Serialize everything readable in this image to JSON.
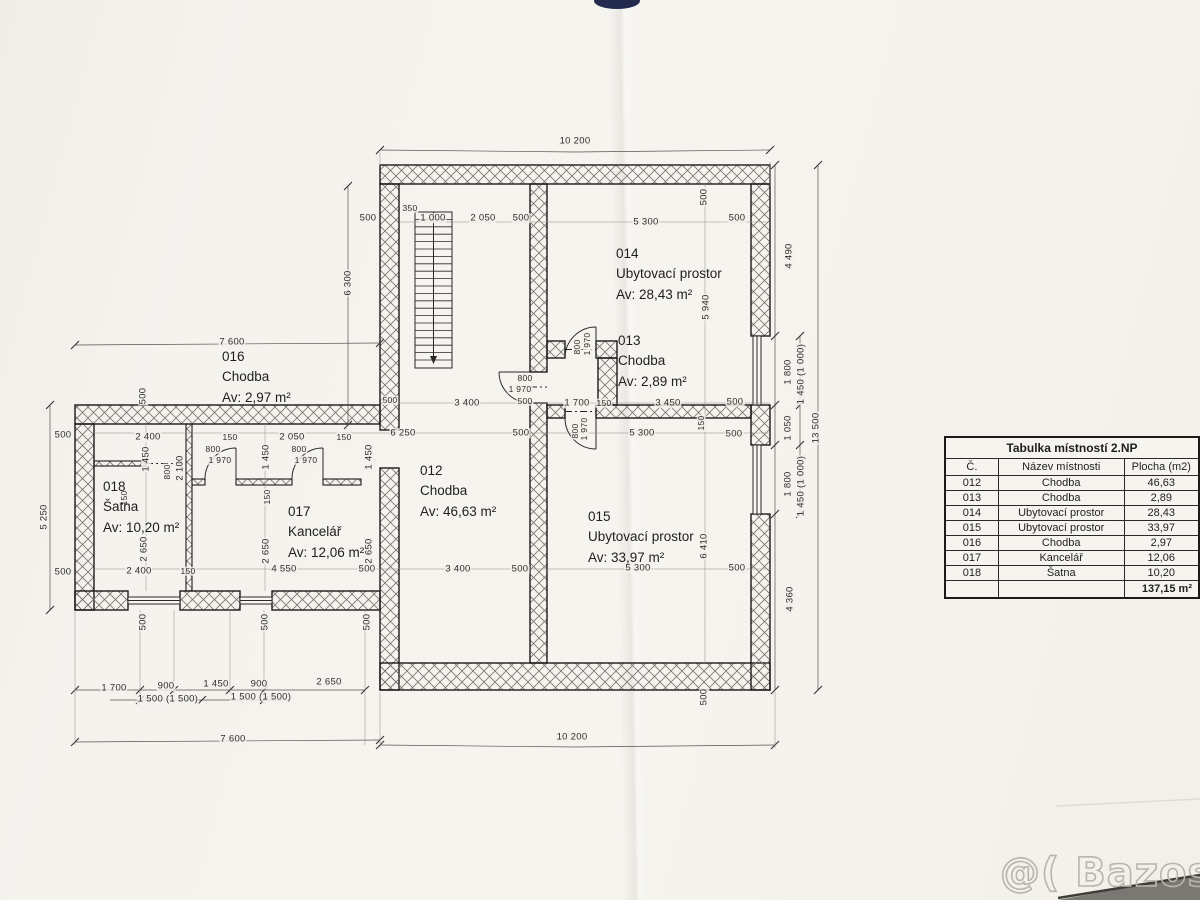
{
  "table": {
    "title": "Tabulka místností 2.NP",
    "headers": [
      "Č.",
      "Název místnosti",
      "Plocha (m2)"
    ],
    "rows": [
      [
        "012",
        "Chodba",
        "46,63"
      ],
      [
        "013",
        "Chodba",
        "2,89"
      ],
      [
        "014",
        "Ubytovací prostor",
        "28,43"
      ],
      [
        "015",
        "Ubytovací prostor",
        "33,97"
      ],
      [
        "016",
        "Chodba",
        "2,97"
      ],
      [
        "017",
        "Kancelář",
        "12,06"
      ],
      [
        "018",
        "Šatna",
        "10,20"
      ]
    ],
    "total": "137,15 m²"
  },
  "rooms": [
    {
      "num": "012",
      "name": "Chodba",
      "area": "Av: 46,63 m²",
      "x": 420,
      "y": 461
    },
    {
      "num": "013",
      "name": "Chodba",
      "area": "Av: 2,89 m²",
      "x": 618,
      "y": 331
    },
    {
      "num": "014",
      "name": "Ubytovací prostor",
      "area": "Av: 28,43 m²",
      "x": 616,
      "y": 244
    },
    {
      "num": "015",
      "name": "Ubytovací prostor",
      "area": "Av: 33,97 m²",
      "x": 588,
      "y": 507
    },
    {
      "num": "016",
      "name": "Chodba",
      "area": "Av: 2,97 m²",
      "x": 222,
      "y": 347
    },
    {
      "num": "017",
      "name": "Kancelář",
      "area": "Av: 12,06 m²",
      "x": 288,
      "y": 502
    },
    {
      "num": "018",
      "name": "Šatna",
      "area": "Av: 10,20 m²",
      "x": 103,
      "y": 477
    }
  ],
  "dimensions": [
    {
      "t": "10 200",
      "x": 575,
      "y": 141
    },
    {
      "t": "500",
      "x": 368,
      "y": 218
    },
    {
      "t": "350",
      "x": 410,
      "y": 208,
      "sm": true
    },
    {
      "t": "1 000",
      "x": 433,
      "y": 218
    },
    {
      "t": "2 050",
      "x": 483,
      "y": 218
    },
    {
      "t": "500",
      "x": 521,
      "y": 218
    },
    {
      "t": "5 300",
      "x": 646,
      "y": 222
    },
    {
      "t": "500",
      "x": 737,
      "y": 218
    },
    {
      "t": "500",
      "x": 704,
      "y": 197,
      "rot": true
    },
    {
      "t": "6 300",
      "x": 348,
      "y": 283,
      "rot": true
    },
    {
      "t": "5 940",
      "x": 706,
      "y": 307,
      "rot": true
    },
    {
      "t": "4 490",
      "x": 789,
      "y": 256,
      "rot": true
    },
    {
      "t": "7 600",
      "x": 232,
      "y": 342
    },
    {
      "t": "800",
      "x": 525,
      "y": 378,
      "sm": true
    },
    {
      "t": "1 970",
      "x": 520,
      "y": 389,
      "sm": true
    },
    {
      "t": "500",
      "x": 525,
      "y": 401,
      "sm": true
    },
    {
      "t": "3 400",
      "x": 467,
      "y": 403
    },
    {
      "t": "1 700",
      "x": 577,
      "y": 403
    },
    {
      "t": "150",
      "x": 604,
      "y": 403,
      "sm": true
    },
    {
      "t": "3 450",
      "x": 668,
      "y": 403
    },
    {
      "t": "500",
      "x": 735,
      "y": 402
    },
    {
      "t": "800",
      "x": 577,
      "y": 347,
      "rot": true,
      "sm": true
    },
    {
      "t": "1 970",
      "x": 587,
      "y": 344,
      "rot": true,
      "sm": true
    },
    {
      "t": "500",
      "x": 63,
      "y": 435
    },
    {
      "t": "500",
      "x": 63,
      "y": 572
    },
    {
      "t": "5 250",
      "x": 44,
      "y": 517,
      "rot": true
    },
    {
      "t": "500",
      "x": 143,
      "y": 396,
      "rot": true
    },
    {
      "t": "500",
      "x": 390,
      "y": 400,
      "sm": true
    },
    {
      "t": "2 400",
      "x": 148,
      "y": 437
    },
    {
      "t": "150",
      "x": 230,
      "y": 437,
      "sm": true
    },
    {
      "t": "2 050",
      "x": 292,
      "y": 437
    },
    {
      "t": "150",
      "x": 344,
      "y": 437,
      "sm": true
    },
    {
      "t": "1 450",
      "x": 146,
      "y": 459,
      "rot": true
    },
    {
      "t": "1 450",
      "x": 266,
      "y": 457,
      "rot": true
    },
    {
      "t": "1 450",
      "x": 369,
      "y": 457,
      "rot": true
    },
    {
      "t": "800",
      "x": 213,
      "y": 449,
      "sm": true
    },
    {
      "t": "1 970",
      "x": 220,
      "y": 460,
      "sm": true
    },
    {
      "t": "800",
      "x": 299,
      "y": 449,
      "sm": true
    },
    {
      "t": "1 970",
      "x": 306,
      "y": 460,
      "sm": true
    },
    {
      "t": "800",
      "x": 167,
      "y": 472,
      "rot": true,
      "sm": true
    },
    {
      "t": "2 100",
      "x": 180,
      "y": 468,
      "rot": true
    },
    {
      "t": "150",
      "x": 124,
      "y": 498,
      "rot": true,
      "sm": true
    },
    {
      "t": "150",
      "x": 267,
      "y": 497,
      "rot": true,
      "sm": true
    },
    {
      "t": "2 650",
      "x": 144,
      "y": 549,
      "rot": true
    },
    {
      "t": "2 650",
      "x": 266,
      "y": 551,
      "rot": true
    },
    {
      "t": "2 650",
      "x": 369,
      "y": 551,
      "rot": true
    },
    {
      "t": "2 400",
      "x": 139,
      "y": 571
    },
    {
      "t": "150",
      "x": 188,
      "y": 571,
      "sm": true
    },
    {
      "t": "4 550",
      "x": 284,
      "y": 569
    },
    {
      "t": "500",
      "x": 367,
      "y": 569
    },
    {
      "t": "500",
      "x": 143,
      "y": 622,
      "rot": true
    },
    {
      "t": "500",
      "x": 265,
      "y": 622,
      "rot": true
    },
    {
      "t": "500",
      "x": 367,
      "y": 622,
      "rot": true
    },
    {
      "t": "1 700",
      "x": 114,
      "y": 688
    },
    {
      "t": "900",
      "x": 166,
      "y": 686
    },
    {
      "t": "1 450",
      "x": 216,
      "y": 684
    },
    {
      "t": "900",
      "x": 259,
      "y": 684
    },
    {
      "t": "2 650",
      "x": 329,
      "y": 682
    },
    {
      "t": "1 500 (1 500)",
      "x": 168,
      "y": 699
    },
    {
      "t": "1 500 (1 500)",
      "x": 261,
      "y": 697
    },
    {
      "t": "7 600",
      "x": 233,
      "y": 739
    },
    {
      "t": "10 200",
      "x": 572,
      "y": 737
    },
    {
      "t": "6 250",
      "x": 403,
      "y": 433
    },
    {
      "t": "500",
      "x": 521,
      "y": 433
    },
    {
      "t": "5 300",
      "x": 642,
      "y": 433
    },
    {
      "t": "150",
      "x": 701,
      "y": 423,
      "rot": true,
      "sm": true
    },
    {
      "t": "500",
      "x": 734,
      "y": 434
    },
    {
      "t": "800",
      "x": 575,
      "y": 431,
      "rot": true,
      "sm": true
    },
    {
      "t": "1 970",
      "x": 584,
      "y": 429,
      "rot": true,
      "sm": true
    },
    {
      "t": "3 400",
      "x": 458,
      "y": 569
    },
    {
      "t": "500",
      "x": 520,
      "y": 569
    },
    {
      "t": "5 300",
      "x": 638,
      "y": 568
    },
    {
      "t": "6 410",
      "x": 704,
      "y": 546,
      "rot": true
    },
    {
      "t": "500",
      "x": 737,
      "y": 568
    },
    {
      "t": "1 800",
      "x": 788,
      "y": 372,
      "rot": true
    },
    {
      "t": "1 450 (1 000)",
      "x": 801,
      "y": 374,
      "rot": true
    },
    {
      "t": "1 050",
      "x": 788,
      "y": 428,
      "rot": true
    },
    {
      "t": "13 500",
      "x": 816,
      "y": 428,
      "rot": true
    },
    {
      "t": "1 800",
      "x": 788,
      "y": 484,
      "rot": true
    },
    {
      "t": "1 450 (1 000)",
      "x": 801,
      "y": 486,
      "rot": true
    },
    {
      "t": "4 360",
      "x": 790,
      "y": 599,
      "rot": true
    },
    {
      "t": "500",
      "x": 704,
      "y": 697,
      "rot": true
    }
  ],
  "watermark": "@( Bazos.cz",
  "colors": {
    "paper": "#f4f2ec",
    "ink": "#1c1b19",
    "hatch": "#6f6d68",
    "navy_blob": "#222b4e",
    "watermark_grey": "#b8b5ae"
  }
}
